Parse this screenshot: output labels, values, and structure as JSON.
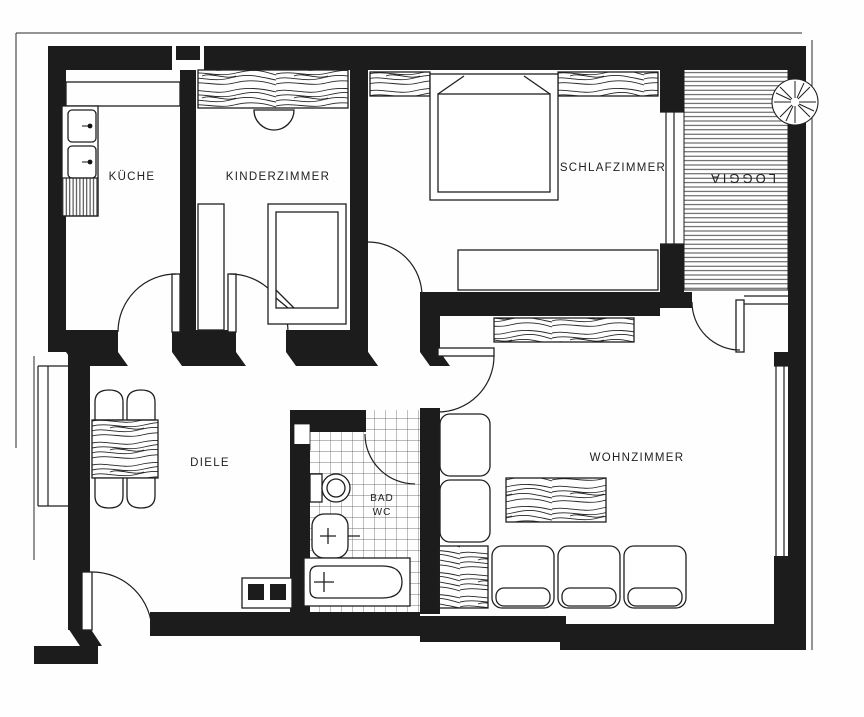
{
  "plan": {
    "type": "apartment-floor-plan",
    "rooms": {
      "kueche": {
        "label": "KÜCHE"
      },
      "kinderzimmer": {
        "label": "KINDERZIMMER"
      },
      "schlafzimmer": {
        "label": "SCHLAFZIMMER"
      },
      "loggia": {
        "label": "LOGGIA"
      },
      "diele": {
        "label": "DIELE"
      },
      "bad": {
        "line1": "BAD",
        "line2": "WC"
      },
      "wohnzimmer": {
        "label": "WOHNZIMMER"
      }
    },
    "colors": {
      "wall": "#1c1c1c",
      "paper": "#fefefe",
      "ink": "#1f1f1f"
    }
  }
}
